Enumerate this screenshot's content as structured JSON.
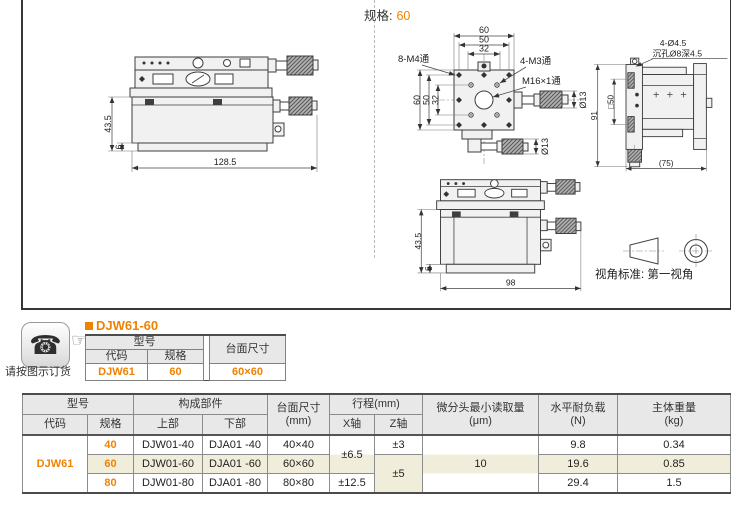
{
  "page": {
    "spec_label": "规格:",
    "spec_value": "60",
    "view_standard": "视角标准: 第一视角"
  },
  "drawings": {
    "side_view": {
      "height": "43.5",
      "base": "6",
      "width": "128.5"
    },
    "top_view": {
      "top_dims": [
        "60",
        "50",
        "32"
      ],
      "left_dims": [
        "60",
        "50",
        "32"
      ],
      "label_m4": "8-M4通",
      "label_m3": "4-M3通",
      "label_m16": "M16×1通",
      "mic_dia_right": "Ø13",
      "mic_dia_bottom": "Ø13"
    },
    "right_view": {
      "label_holes": "4-Ø4.5",
      "label_counterbore": "沉孔Ø8深4.5",
      "height": "91",
      "square": "□50",
      "width": "(75)"
    },
    "front_view": {
      "height": "43.5",
      "base": "6",
      "width": "98"
    }
  },
  "order": {
    "note": "请按图示订货",
    "product_code": "DJW61-60",
    "table": {
      "model_header": "型号",
      "code_header": "代码",
      "spec_header": "规格",
      "size_header": "台面尺寸",
      "code": "DJW61",
      "spec": "60",
      "size": "60×60"
    }
  },
  "spec_table": {
    "headers": {
      "model": "型号",
      "code": "代码",
      "spec": "规格",
      "components": "构成部件",
      "upper": "上部",
      "lower": "下部",
      "size": "台面尺寸",
      "size_unit": "(mm)",
      "travel": "行程(mm)",
      "x_axis": "X轴",
      "z_axis": "Z轴",
      "micrometer": "微分头最小读取量",
      "micrometer_unit": "(μm)",
      "load": "水平耐负载",
      "load_unit": "(N)",
      "weight": "主体重量",
      "weight_unit": "(kg)"
    },
    "code": "DJW61",
    "rows": [
      {
        "spec": "40",
        "upper": "DJW01-40",
        "lower": "DJA01 -40",
        "size": "40×40",
        "load": "9.8",
        "weight": "0.34"
      },
      {
        "spec": "60",
        "upper": "DJW01-60",
        "lower": "DJA01 -60",
        "size": "60×60",
        "load": "19.6",
        "weight": "0.85"
      },
      {
        "spec": "80",
        "upper": "DJW01-80",
        "lower": "DJA01 -80",
        "size": "80×80",
        "load": "29.4",
        "weight": "1.5"
      }
    ],
    "travel": {
      "x_40_60": "±6.5",
      "x_80": "±12.5",
      "z_40": "±3",
      "z_60_80": "±5"
    },
    "micrometer_value": "10"
  },
  "colors": {
    "accent": "#ef8200",
    "row_highlight": "#f0eedb",
    "header_bg": "#e8e8e8"
  }
}
